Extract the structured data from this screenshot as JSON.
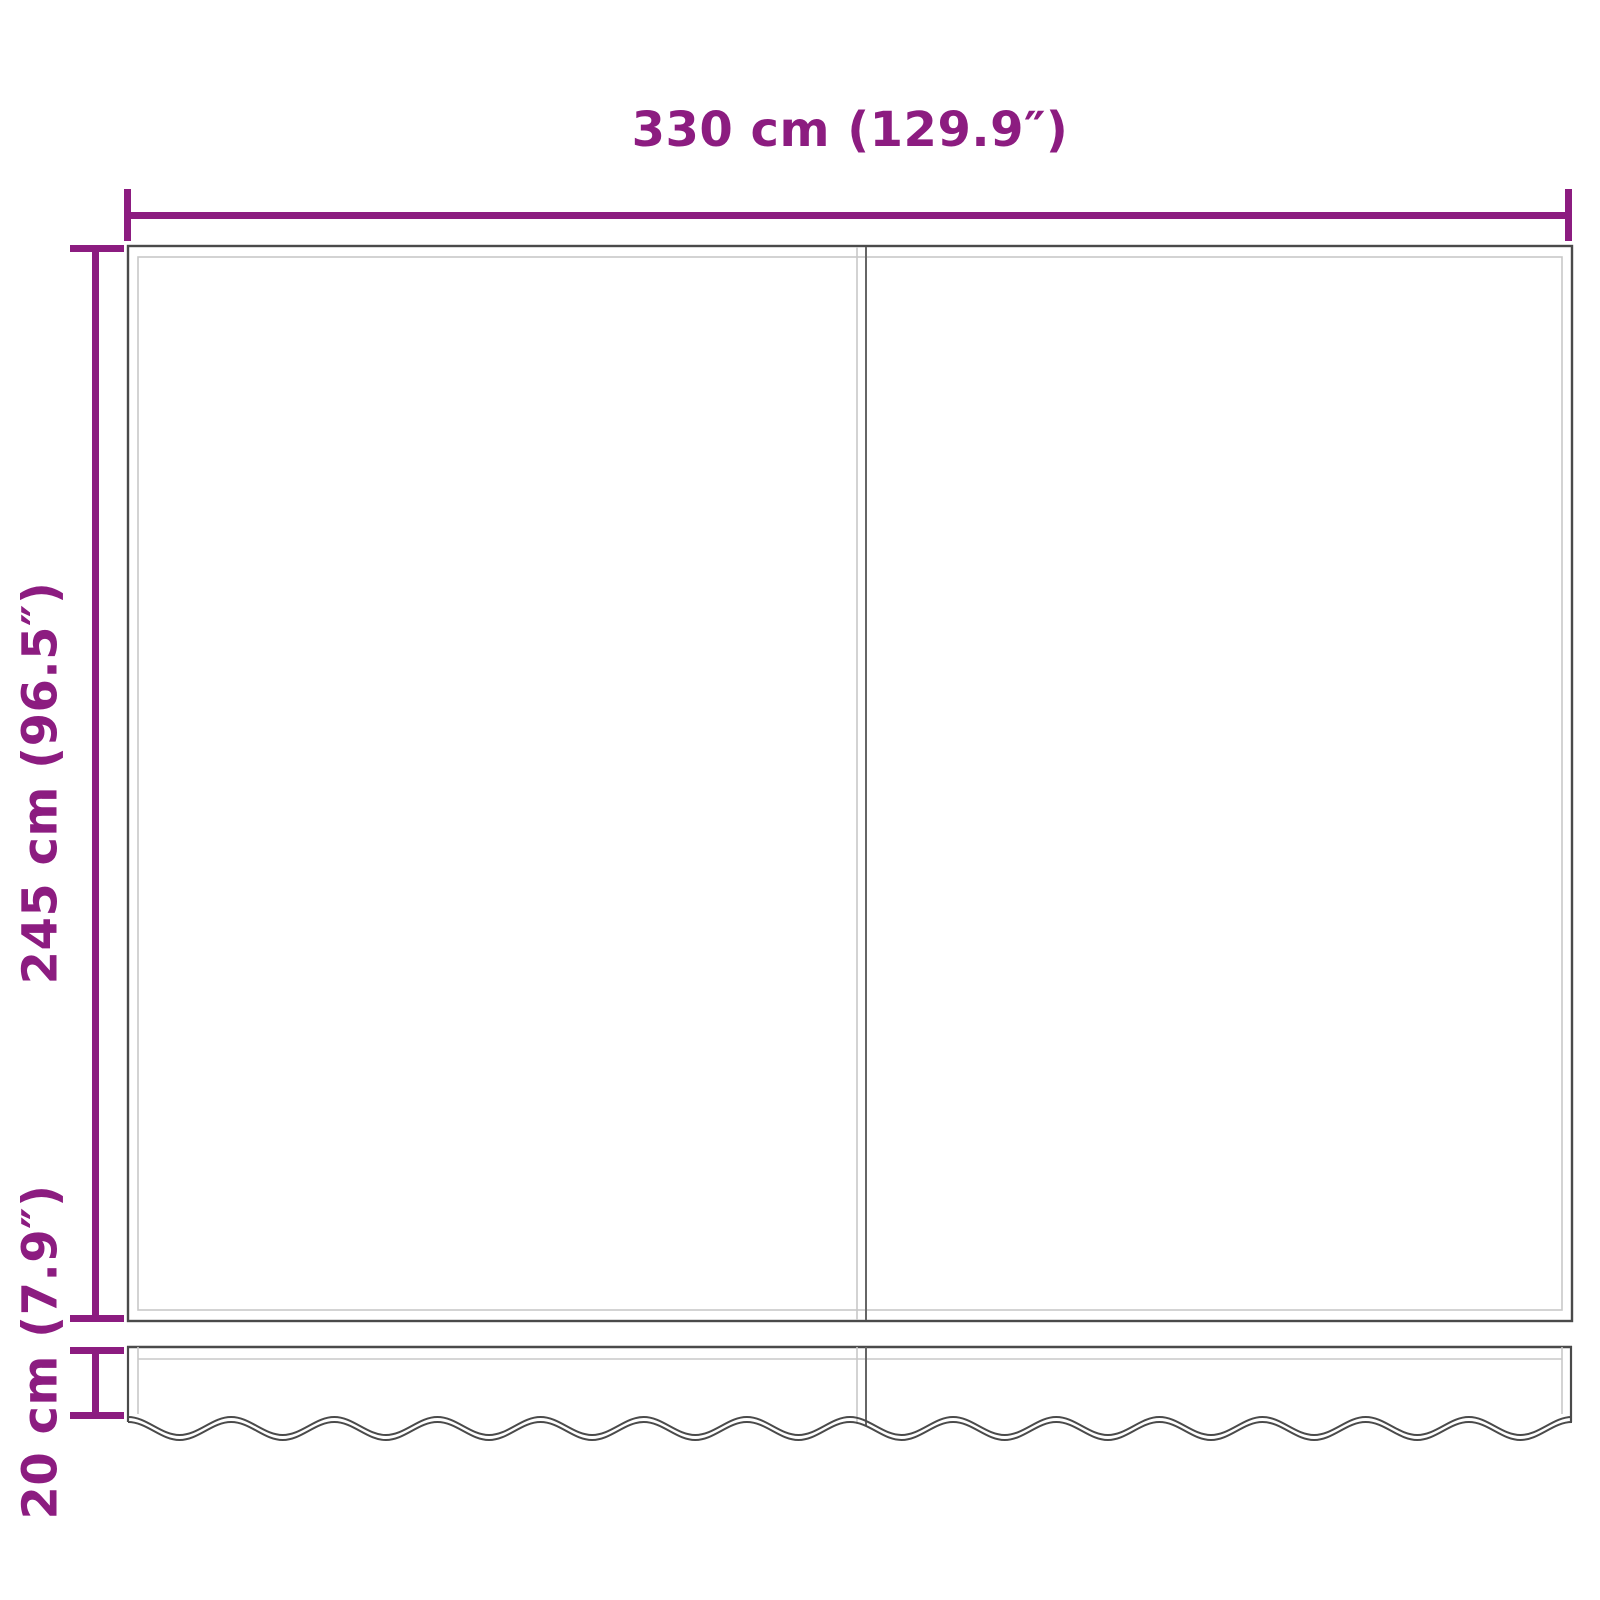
{
  "diagram": {
    "kind": "product-dimension-diagram",
    "subject": "awning replacement fabric (two panels) with wavy valance",
    "dimensions": {
      "width": {
        "label": "330 cm (129.9″)",
        "cm": 330,
        "inches": 129.9
      },
      "height": {
        "label": "245 cm (96.5″)",
        "cm": 245,
        "inches": 96.5
      },
      "valance_height": {
        "label": "20 cm (7.9″)",
        "cm": 20,
        "inches": 7.9
      }
    },
    "colors": {
      "dimension_accent": "#8C1C80",
      "outline_dark": "#4A4A4A",
      "outline_light": "#C8C8C8",
      "seam_dark": "#666666",
      "background": "#FFFFFF"
    }
  }
}
